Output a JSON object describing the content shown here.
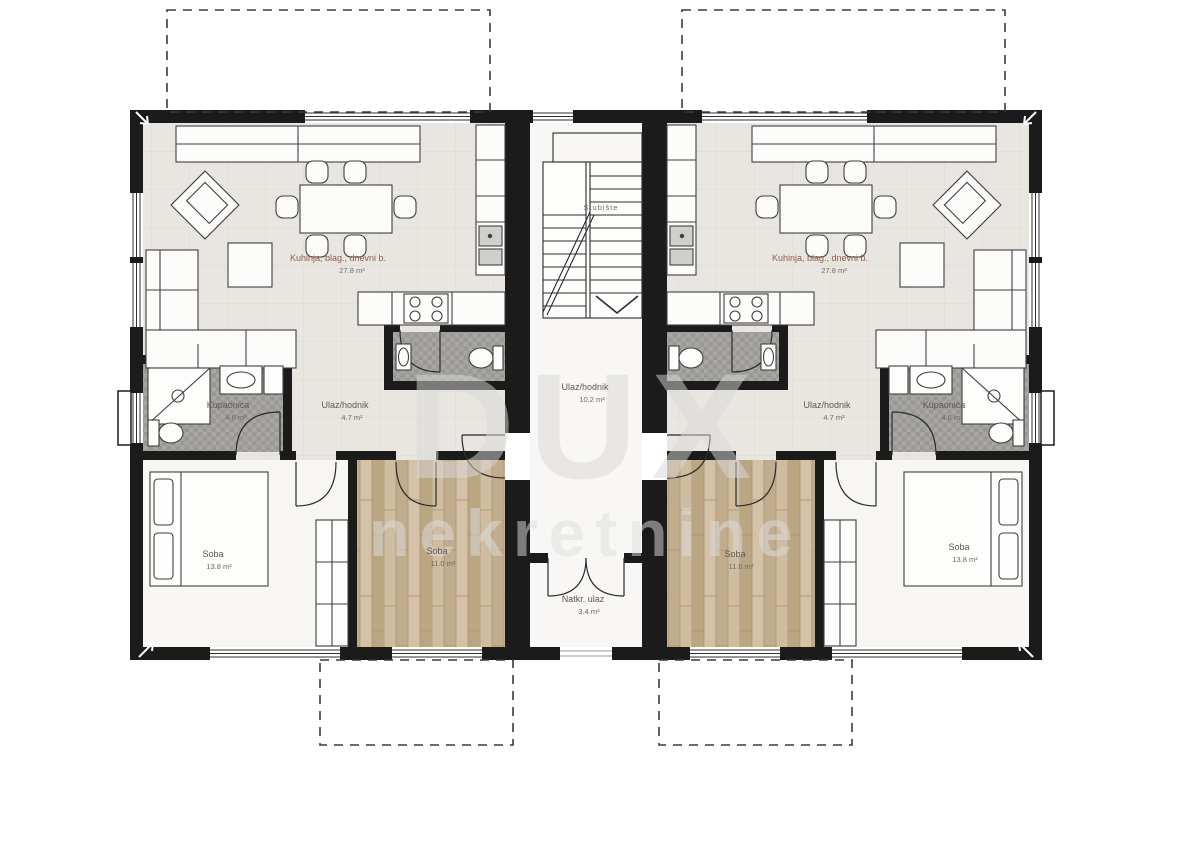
{
  "title": "Apartment floor plan – two mirrored units",
  "watermark": {
    "brand": "DUX",
    "suffix": "nekretnine"
  },
  "apartments": {
    "left": {
      "living": {
        "label": "Kuhinja, blag., dnevni b.",
        "area": "27.8 m²"
      },
      "bathroom": {
        "label": "Kupaonica",
        "area": "4.6 m²"
      },
      "hall": {
        "label": "Ulaz/hodnik",
        "area": "4.7 m²"
      },
      "bedroom_large": {
        "label": "Soba",
        "area": "13.8 m²"
      },
      "bedroom_small": {
        "label": "Soba",
        "area": "11.0 m²"
      }
    },
    "right": {
      "living": {
        "label": "Kuhinja, blag., dnevni b.",
        "area": "27.8 m²"
      },
      "bathroom": {
        "label": "Kupaonica",
        "area": "4.6 m²"
      },
      "hall": {
        "label": "Ulaz/hodnik",
        "area": "4.7 m²"
      },
      "bedroom_large": {
        "label": "Soba",
        "area": "13.8 m²"
      },
      "bedroom_small": {
        "label": "Soba",
        "area": "11.0 m²"
      }
    }
  },
  "core": {
    "staircase": {
      "label": "Stubište"
    },
    "hall": {
      "label": "Ulaz/hodnik",
      "area": "10.2 m²"
    },
    "entrance": {
      "label": "Natkr. ulaz",
      "area": "3.4 m²"
    }
  },
  "colors": {
    "wall": "#1b1b1b",
    "floor_living": "#e9e6e1",
    "floor_bedroom": "#f7f6f3",
    "floor_bath": "#a7a5a1",
    "floor_wood": "#c9b69b",
    "dashed_outline": "#3a3a3a",
    "label": "#5c5853",
    "label_living": "#8a5f4e"
  }
}
